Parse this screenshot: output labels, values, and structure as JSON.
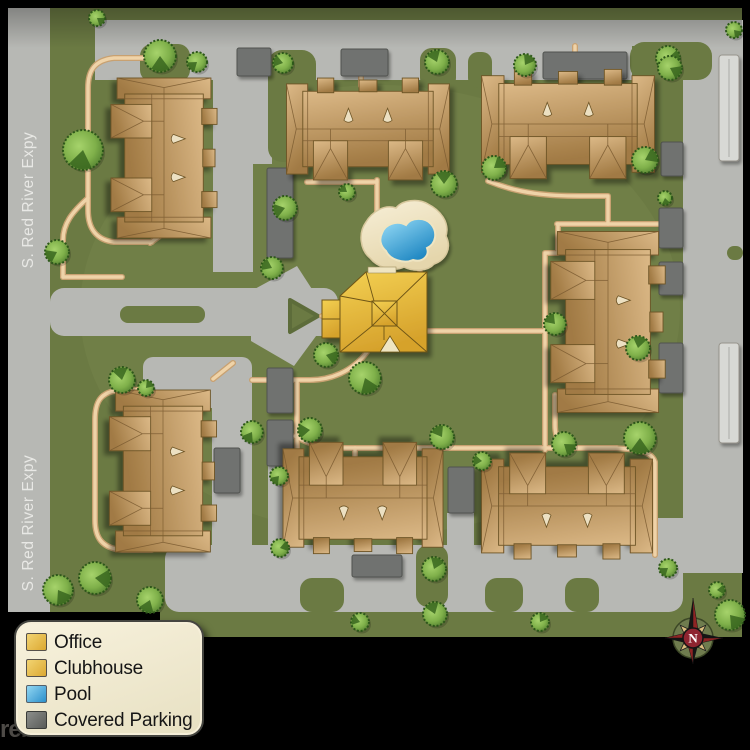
{
  "map": {
    "streets": [
      "S. Red River Expy",
      "S. Red River Expy"
    ],
    "watermark": "rentlinx",
    "compass": {
      "x": 693,
      "y": 638,
      "label": "N"
    },
    "legend": {
      "items": [
        {
          "label": "Office",
          "color": "#dca832",
          "light": "#f2d472",
          "border": "#55504a"
        },
        {
          "label": "Clubhouse",
          "color": "#dca832",
          "light": "#f2d472",
          "border": "#55504a"
        },
        {
          "label": "Pool",
          "color": "#2b90cb",
          "light": "#93d7f2",
          "border": "#55606a"
        },
        {
          "label": "Covered Parking",
          "color": "#595b58",
          "light": "#8c8e8b",
          "border": "#3a3c39"
        }
      ]
    },
    "colors": {
      "ground": "#6b7a43",
      "road": "#b7b8b4",
      "covered_parking": "#70726f",
      "carport": "#d8d9d5",
      "walkway": "#efd3a8",
      "building": "#c49a62",
      "clubhouse_gold": "#e8bf3e",
      "pool_blue": "#3fa0d8",
      "pool_deck": "#efe5c2",
      "tree_light": "#8fc055",
      "tree_dark": "#38661f",
      "street_text": "#ececе9"
    },
    "ground": [
      [
        8,
        8,
        734,
        604
      ],
      [
        160,
        520,
        582,
        117
      ]
    ],
    "roads": [
      [
        8,
        8,
        42,
        604,
        0
      ],
      [
        95,
        20,
        648,
        26,
        0
      ],
      [
        95,
        42,
        537,
        38,
        0
      ],
      [
        683,
        20,
        60,
        553,
        0
      ],
      [
        50,
        288,
        288,
        48,
        14
      ],
      [
        143,
        357,
        109,
        51,
        10
      ],
      [
        213,
        78,
        40,
        194,
        0
      ],
      [
        250,
        78,
        22,
        86,
        0
      ],
      [
        212,
        378,
        40,
        234,
        0
      ],
      [
        268,
        464,
        28,
        148,
        0
      ],
      [
        447,
        513,
        27,
        99,
        0
      ],
      [
        165,
        545,
        518,
        67,
        14
      ],
      [
        620,
        518,
        123,
        55,
        10
      ]
    ],
    "plaza": {
      "diamond": "297,266 330,317 294,366 251,341 251,291",
      "island": "290,300 318,316 290,332"
    },
    "pads": [
      [
        140,
        44,
        50,
        38,
        12
      ],
      [
        268,
        50,
        48,
        112,
        14
      ],
      [
        420,
        48,
        36,
        42,
        12
      ],
      [
        468,
        52,
        24,
        36,
        10
      ],
      [
        630,
        42,
        82,
        38,
        14
      ],
      [
        120,
        306,
        85,
        17,
        8
      ],
      [
        300,
        578,
        44,
        34,
        12
      ],
      [
        416,
        545,
        32,
        62,
        12
      ],
      [
        485,
        578,
        38,
        34,
        12
      ],
      [
        565,
        578,
        34,
        34,
        12
      ],
      [
        727,
        246,
        16,
        14,
        7
      ]
    ],
    "covered": [
      [
        237,
        48,
        34,
        28
      ],
      [
        341,
        49,
        47,
        27
      ],
      [
        543,
        52,
        84,
        27
      ],
      [
        661,
        142,
        22,
        34
      ],
      [
        659,
        208,
        24,
        40
      ],
      [
        659,
        262,
        24,
        33
      ],
      [
        659,
        343,
        24,
        50
      ],
      [
        267,
        168,
        26,
        90
      ],
      [
        267,
        368,
        26,
        45
      ],
      [
        267,
        420,
        26,
        46
      ],
      [
        214,
        448,
        26,
        45
      ],
      [
        352,
        555,
        50,
        22
      ],
      [
        448,
        467,
        26,
        46
      ]
    ],
    "carports": [
      [
        719,
        55,
        20,
        106
      ],
      [
        719,
        343,
        20,
        100
      ]
    ],
    "walkways": [
      "M377,180 V212",
      "M420,268 V274",
      "M427,331 H545",
      "M545,331 V253 H558 V224",
      "M557,224 H660",
      "M488,181 C520,194 550,196 580,196 L608,196 V224",
      "M545,331 V450",
      "M295,436 C312,447 330,448 345,448 H455",
      "M455,448 H600 C640,448 652,452 655,462 V555",
      "M355,448 V460",
      "M427,448 V460",
      "M367,352 C352,372 330,380 310,380 L252,380",
      "M297,382 V476",
      "M334,316 H322",
      "M152,58 H114 C95,60 88,70 88,88 L88,210 C88,228 96,240 114,242 L152,242",
      "M150,243 L188,216",
      "M88,198 C72,212 63,224 63,240 L63,277",
      "M63,277 H122",
      "M150,390 H120 C100,392 95,402 95,420 L95,520 C95,538 102,548 122,550 L152,550",
      "M213,379 L233,363",
      "M555,395 V425 C555,441 562,448 578,448 L617,448",
      "M307,182 H377",
      "M361,76 V86",
      "M575,46 V70"
    ],
    "pool": {
      "deck": "M370,258 C360,250 358,233 366,222 C372,212 384,204 396,208 C402,200 418,198 428,204 C440,210 450,222 446,236 C452,248 446,260 434,264 C428,271 414,272 404,267 C394,272 378,268 370,258 Z",
      "water": "M382,233 C385,224 397,220 406,225 C411,217 425,217 431,224 C438,232 436,244 427,248 C430,256 422,263 413,260 C404,264 390,260 386,251 C380,246 379,239 382,233 Z"
    },
    "clubhouse": {
      "body": "M340,296 L366,272 L427,272 L427,352 L340,352 Z",
      "wing": [
        322,
        300,
        20,
        38
      ],
      "cupola": [
        372,
        301,
        25,
        25
      ],
      "lines": "M340,296 L372,302 M427,272 L397,301 M427,352 L397,326 M340,352 L372,326 M366,272 L374,301 M322,319 L340,319 M384,326 L384,340 M372,301 L397,326 M397,301 L372,326",
      "dormer": "M380,352 L390,336 L400,352 Z",
      "entry": [
        368,
        267,
        28,
        6
      ]
    },
    "buildings": [
      {
        "cx": 164,
        "cy": 158,
        "L": 160,
        "S": 102,
        "rot": 90
      },
      {
        "cx": 368,
        "cy": 129,
        "L": 163,
        "S": 98,
        "rot": 0
      },
      {
        "cx": 568,
        "cy": 124,
        "L": 173,
        "S": 105,
        "rot": 0
      },
      {
        "cx": 608,
        "cy": 322,
        "L": 181,
        "S": 110,
        "rot": 90
      },
      {
        "cx": 163,
        "cy": 471,
        "L": 162,
        "S": 103,
        "rot": 90
      },
      {
        "cx": 363,
        "cy": 498,
        "L": 160,
        "S": 107,
        "rot": 180
      },
      {
        "cx": 567,
        "cy": 506,
        "L": 171,
        "S": 102,
        "rot": 180
      }
    ],
    "trees": [
      [
        97,
        18,
        8
      ],
      [
        160,
        56,
        16
      ],
      [
        197,
        62,
        10
      ],
      [
        283,
        63,
        10
      ],
      [
        437,
        62,
        12
      ],
      [
        525,
        65,
        11
      ],
      [
        668,
        58,
        12
      ],
      [
        734,
        30,
        8
      ],
      [
        83,
        150,
        20
      ],
      [
        57,
        252,
        12
      ],
      [
        272,
        268,
        11
      ],
      [
        122,
        380,
        13
      ],
      [
        146,
        388,
        8
      ],
      [
        95,
        578,
        16
      ],
      [
        58,
        590,
        15
      ],
      [
        150,
        600,
        13
      ],
      [
        285,
        208,
        12
      ],
      [
        347,
        192,
        8
      ],
      [
        444,
        184,
        13
      ],
      [
        494,
        168,
        12
      ],
      [
        326,
        355,
        12
      ],
      [
        365,
        378,
        16
      ],
      [
        252,
        432,
        11
      ],
      [
        310,
        430,
        12
      ],
      [
        555,
        324,
        11
      ],
      [
        638,
        348,
        12
      ],
      [
        645,
        160,
        13
      ],
      [
        670,
        68,
        12
      ],
      [
        665,
        198,
        7
      ],
      [
        279,
        476,
        9
      ],
      [
        482,
        461,
        9
      ],
      [
        442,
        437,
        12
      ],
      [
        434,
        569,
        12
      ],
      [
        280,
        548,
        9
      ],
      [
        564,
        444,
        12
      ],
      [
        640,
        438,
        16
      ],
      [
        668,
        568,
        9
      ],
      [
        360,
        622,
        9
      ],
      [
        435,
        614,
        12
      ],
      [
        540,
        622,
        9
      ],
      [
        717,
        590,
        8
      ],
      [
        730,
        615,
        15
      ]
    ]
  }
}
